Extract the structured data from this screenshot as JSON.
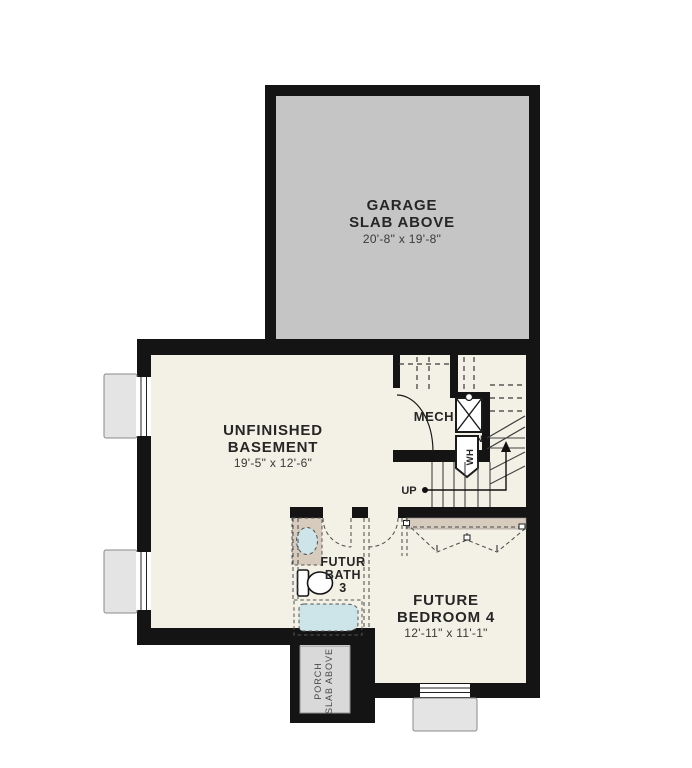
{
  "plan": {
    "rooms": {
      "garage": {
        "name_line1": "GARAGE",
        "name_line2": "SLAB ABOVE",
        "dims": "20'-8\" x 19'-8\""
      },
      "basement": {
        "name_line1": "UNFINISHED",
        "name_line2": "BASEMENT",
        "dims": "19'-5\" x 12'-6\""
      },
      "mech": {
        "name": "MECH."
      },
      "bath": {
        "name_line1": "FUTUR",
        "name_line2": "BATH",
        "name_line3": "3"
      },
      "bedroom": {
        "name_line1": "FUTURE",
        "name_line2": "BEDROOM 4",
        "dims": "12'-11\" x 11'-1\""
      },
      "porch": {
        "name_line1": "PORCH",
        "name_line2": "SLAB ABOVE"
      }
    },
    "labels": {
      "up": "UP",
      "furnace": "FURN",
      "water_heater": "WH"
    },
    "colors": {
      "wall": "#141414",
      "garage_slab": "#c5c5c5",
      "floor": "#f3f0e5",
      "fixture_blue": "#cde4e9",
      "counter_tan": "#d7cbbd",
      "well_gray": "#e4e4e4",
      "porch_slab": "#d9d9d9"
    }
  }
}
